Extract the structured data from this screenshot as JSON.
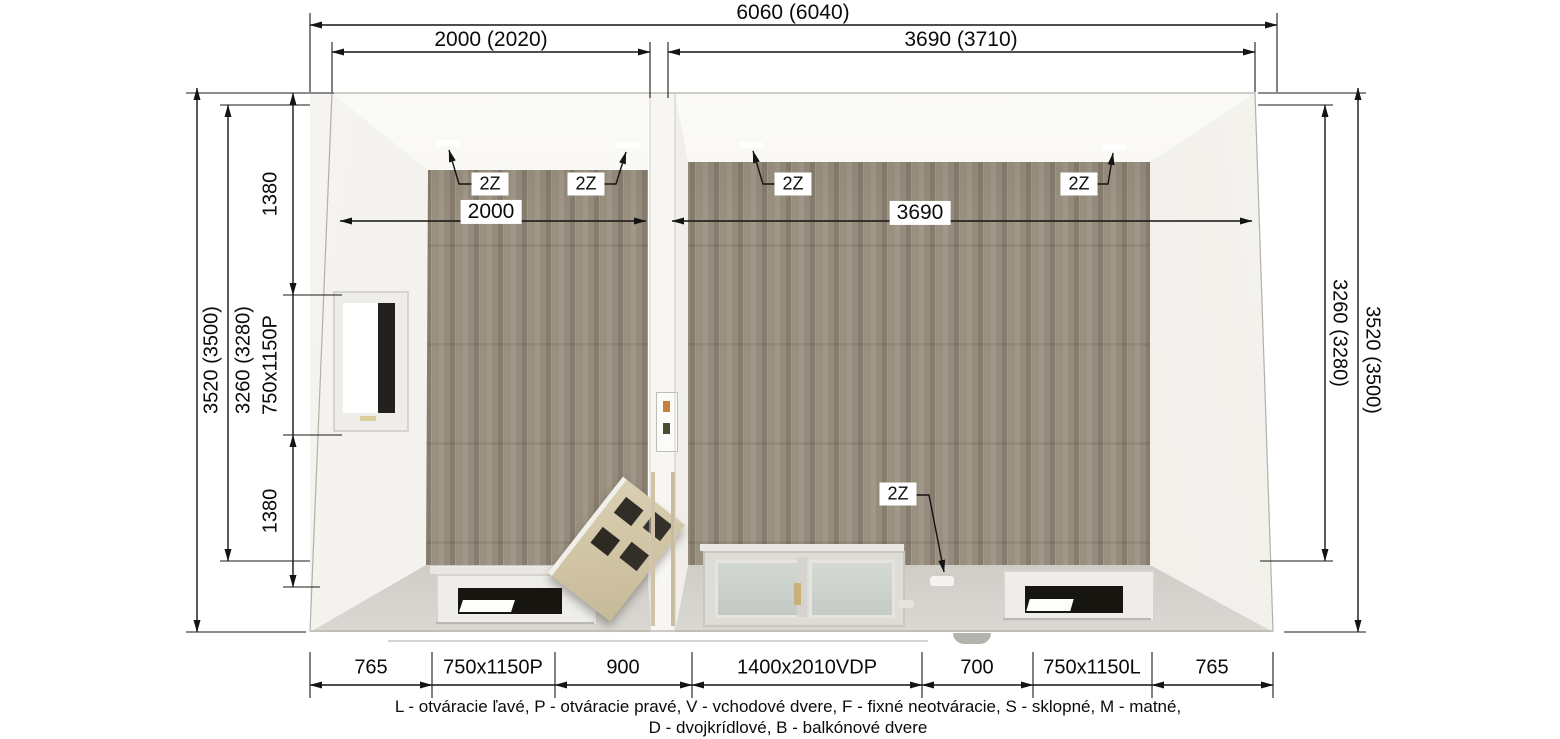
{
  "drawing": {
    "type": "top-view floor plan render of a two-room modular cabin",
    "dimensions": {
      "top": {
        "total": "6060 (6040)",
        "left_module": "2000 (2020)",
        "right_module": "3690 (3710)"
      },
      "left_side": {
        "outer": "3520 (3500)",
        "inner": "3260 (3280)",
        "segments": [
          "1380",
          "750x1150P",
          "1380"
        ]
      },
      "right_side": {
        "inner": "3260 (3280)",
        "outer": "3520 (3500)"
      },
      "bottom": {
        "segments": [
          "765",
          "750x1150P",
          "900",
          "1400x2010VDP",
          "700",
          "750x1150L",
          "765"
        ]
      },
      "interior": {
        "left_room_width": "2000",
        "right_room_width": "3690"
      }
    },
    "markers": {
      "double_socket": "2Z"
    },
    "legend": {
      "line1": "L - otváracie ľavé, P - otváracie pravé, V - vchodové dvere, F - fixné neotváracie, S - sklopné, M - matné,",
      "line2": "D - dvojkrídlové, B - balkónové dvere"
    },
    "colors": {
      "floor_wood": "#988d7e",
      "wall_light": "#f4f2ed",
      "wall_shadow": "#cac7c1",
      "dimension_lines": "#141414",
      "door_glass": "#c9cfc9",
      "leaning_door_wood": "#d3c6a8"
    }
  }
}
